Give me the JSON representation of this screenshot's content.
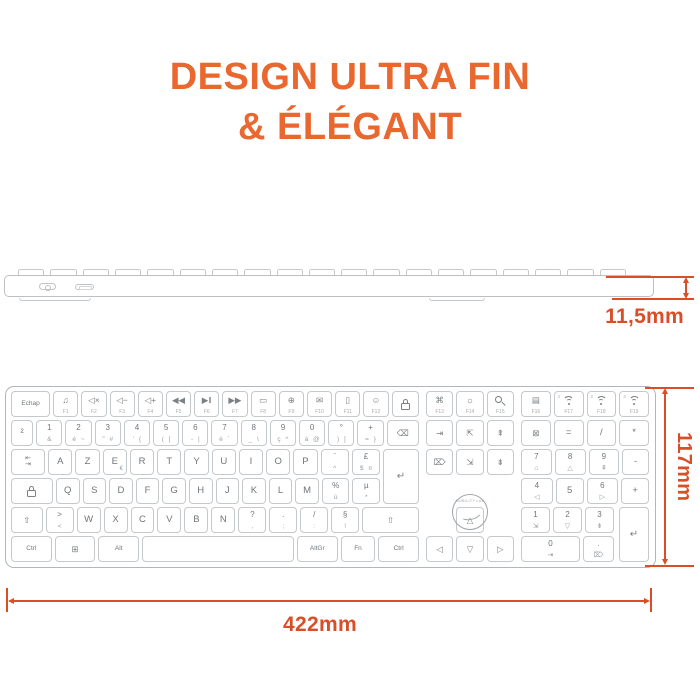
{
  "title": {
    "line1": "DESIGN ULTRA FIN",
    "line2": "& ÉLÉGANT"
  },
  "colors": {
    "title_orange": "#E8682F",
    "dimension_orange": "#D94E27",
    "keyboard_border": "#B2B6B9",
    "key_border": "#C6C9CC",
    "key_text": "#70767A"
  },
  "dimensions": {
    "thickness": "11,5mm",
    "height": "117mm",
    "width": "422mm"
  },
  "side_view": {
    "power_switch_icon": "power-switch-icon",
    "usb_port_icon": "usb-c-port-icon"
  },
  "keyboard": {
    "logo_text": "MOBILITY LAB",
    "enter_main": {
      "icon": "enter",
      "name": "key-enter"
    },
    "enter_num": {
      "icon": "enter",
      "name": "key-num-enter"
    },
    "rows": [
      {
        "main": [
          {
            "t": "Echap",
            "flex": 1.6,
            "name": "key-echap"
          },
          {
            "icon": "music",
            "f": "F1",
            "name": "key-f1"
          },
          {
            "icon": "mute",
            "f": "F2",
            "name": "key-f2"
          },
          {
            "icon": "voldown",
            "f": "F3",
            "name": "key-f3"
          },
          {
            "icon": "volup",
            "f": "F4",
            "name": "key-f4"
          },
          {
            "icon": "prev",
            "f": "F5",
            "name": "key-f5"
          },
          {
            "icon": "play",
            "f": "F6",
            "name": "key-f6"
          },
          {
            "icon": "next",
            "f": "F7",
            "name": "key-f7"
          },
          {
            "icon": "window",
            "f": "F8",
            "name": "key-f8"
          },
          {
            "icon": "globe",
            "f": "F9",
            "name": "key-f9"
          },
          {
            "icon": "mail",
            "f": "F10",
            "name": "key-f10"
          },
          {
            "icon": "phone",
            "f": "F11",
            "name": "key-f11"
          },
          {
            "icon": "emoji",
            "f": "F12",
            "name": "key-f12"
          },
          {
            "icon": "lock",
            "flex": 1.1,
            "name": "key-lock"
          }
        ],
        "nav": [
          {
            "icon": "screenshot",
            "f": "F13",
            "name": "key-f13"
          },
          {
            "icon": "backlight",
            "f": "F14",
            "name": "key-f14"
          },
          {
            "icon": "search",
            "f": "F15",
            "name": "key-f15"
          }
        ],
        "num": [
          {
            "icon": "printer",
            "f": "F16",
            "name": "key-f16"
          },
          {
            "icon": "wifi",
            "f": "F17",
            "corner": "1",
            "name": "key-f17"
          },
          {
            "icon": "wifi",
            "f": "F18",
            "corner": "2",
            "name": "key-f18"
          },
          {
            "icon": "wifi",
            "f": "F19",
            "corner": "3",
            "name": "key-f19"
          }
        ]
      },
      {
        "main": [
          {
            "t": "²",
            "name": "key-superscript-2"
          },
          {
            "t": "1",
            "b": "&"
          },
          {
            "t": "2",
            "b": "é ~"
          },
          {
            "t": "3",
            "b": "\" #"
          },
          {
            "t": "4",
            "b": "' {"
          },
          {
            "t": "5",
            "b": "( ["
          },
          {
            "t": "6",
            "b": "- |"
          },
          {
            "t": "7",
            "b": "è `"
          },
          {
            "t": "8",
            "b": "_ \\"
          },
          {
            "t": "9",
            "b": "ç ^"
          },
          {
            "t": "0",
            "b": "à @"
          },
          {
            "t": "°",
            "b": ") ]"
          },
          {
            "t": "+",
            "b": "= }"
          },
          {
            "icon": "backspace",
            "flex": 1.5,
            "name": "key-backspace"
          }
        ],
        "nav": [
          {
            "icon": "insert",
            "name": "key-insert"
          },
          {
            "icon": "homecorner",
            "name": "key-home"
          },
          {
            "icon": "pageup",
            "name": "key-page-up"
          }
        ],
        "num": [
          {
            "icon": "numlock",
            "name": "key-num-lock"
          },
          {
            "t": "=",
            "name": "key-num-equals"
          },
          {
            "t": "/",
            "name": "key-num-divide"
          },
          {
            "t": "*",
            "name": "key-num-multiply"
          }
        ]
      },
      {
        "main": [
          {
            "icon": "tab",
            "flex": 1.45,
            "name": "key-tab"
          },
          {
            "t": "A"
          },
          {
            "t": "Z"
          },
          {
            "t": "E",
            "br": "€"
          },
          {
            "t": "R"
          },
          {
            "t": "T"
          },
          {
            "t": "Y"
          },
          {
            "t": "U"
          },
          {
            "t": "I"
          },
          {
            "t": "O"
          },
          {
            "t": "P"
          },
          {
            "t": "¨",
            "b": "^",
            "name": "key-diaeresis"
          },
          {
            "t": "£",
            "b": "$ ¤",
            "name": "key-pound-dollar"
          }
        ],
        "nav": [
          {
            "icon": "del",
            "name": "key-delete"
          },
          {
            "icon": "endcorner",
            "name": "key-end"
          },
          {
            "icon": "pagedown",
            "name": "key-page-down"
          }
        ],
        "num": [
          {
            "t": "7",
            "bi": "home",
            "name": "key-num-7"
          },
          {
            "t": "8",
            "bi": "up",
            "name": "key-num-8"
          },
          {
            "t": "9",
            "bi": "pageup",
            "name": "key-num-9"
          },
          {
            "t": "-",
            "name": "key-num-minus"
          }
        ]
      },
      {
        "main": [
          {
            "icon": "caps",
            "flex": 1.85,
            "name": "key-caps-lock"
          },
          {
            "t": "Q"
          },
          {
            "t": "S"
          },
          {
            "t": "D"
          },
          {
            "t": "F"
          },
          {
            "t": "G"
          },
          {
            "t": "H"
          },
          {
            "t": "J"
          },
          {
            "t": "K"
          },
          {
            "t": "L"
          },
          {
            "t": "M"
          },
          {
            "t": "%",
            "b": "ù",
            "name": "key-percent-u"
          },
          {
            "t": "µ",
            "b": "*",
            "name": "key-micro-asterisk"
          }
        ],
        "nav": [
          {
            "spacer": true
          },
          {
            "spacer": true
          },
          {
            "spacer": true
          }
        ],
        "num": [
          {
            "t": "4",
            "bi": "left",
            "name": "key-num-4"
          },
          {
            "t": "5",
            "name": "key-num-5"
          },
          {
            "t": "6",
            "bi": "right",
            "name": "key-num-6"
          },
          {
            "t": "+",
            "name": "key-num-plus"
          }
        ]
      },
      {
        "main": [
          {
            "icon": "shift",
            "flex": 1.35,
            "name": "key-shift-left"
          },
          {
            "t": ">",
            "b": "<",
            "name": "key-angle-brackets"
          },
          {
            "t": "W"
          },
          {
            "t": "X"
          },
          {
            "t": "C"
          },
          {
            "t": "V"
          },
          {
            "t": "B"
          },
          {
            "t": "N"
          },
          {
            "t": "?",
            "b": ",",
            "name": "key-question-comma"
          },
          {
            "t": ".",
            "b": ";",
            "name": "key-period-semicolon"
          },
          {
            "t": "/",
            "b": ":",
            "name": "key-slash-colon"
          },
          {
            "t": "§",
            "b": "!",
            "name": "key-section-exclamation"
          },
          {
            "icon": "shift",
            "flex": 2.5,
            "name": "key-shift-right"
          }
        ],
        "nav": [
          {
            "spacer": true
          },
          {
            "icon": "up",
            "name": "key-arrow-up"
          },
          {
            "spacer": true
          }
        ],
        "num": [
          {
            "t": "1",
            "bi": "endcorner",
            "name": "key-num-1"
          },
          {
            "t": "2",
            "bi": "down",
            "name": "key-num-2"
          },
          {
            "t": "3",
            "bi": "pagedown",
            "name": "key-num-3"
          }
        ]
      },
      {
        "main": [
          {
            "t": "Ctrl",
            "flex": 1.6,
            "name": "key-ctrl-left"
          },
          {
            "icon": "win",
            "flex": 1.6,
            "name": "key-windows"
          },
          {
            "t": "Alt",
            "flex": 1.6,
            "name": "key-alt"
          },
          {
            "t": "",
            "flex": 6.2,
            "name": "key-space"
          },
          {
            "t": "AltGr",
            "flex": 1.6,
            "name": "key-altgr"
          },
          {
            "t": "Fn",
            "flex": 1.35,
            "name": "key-fn"
          },
          {
            "t": "Ctrl",
            "flex": 1.6,
            "name": "key-ctrl-right"
          }
        ],
        "nav": [
          {
            "icon": "left",
            "name": "key-arrow-left"
          },
          {
            "icon": "down",
            "name": "key-arrow-down"
          },
          {
            "icon": "right",
            "name": "key-arrow-right"
          }
        ],
        "num": [
          {
            "t": "0",
            "flex": 2.1,
            "bi": "insert",
            "name": "key-num-0"
          },
          {
            "t": ".",
            "bi": "del",
            "name": "key-num-decimal"
          }
        ]
      }
    ]
  }
}
